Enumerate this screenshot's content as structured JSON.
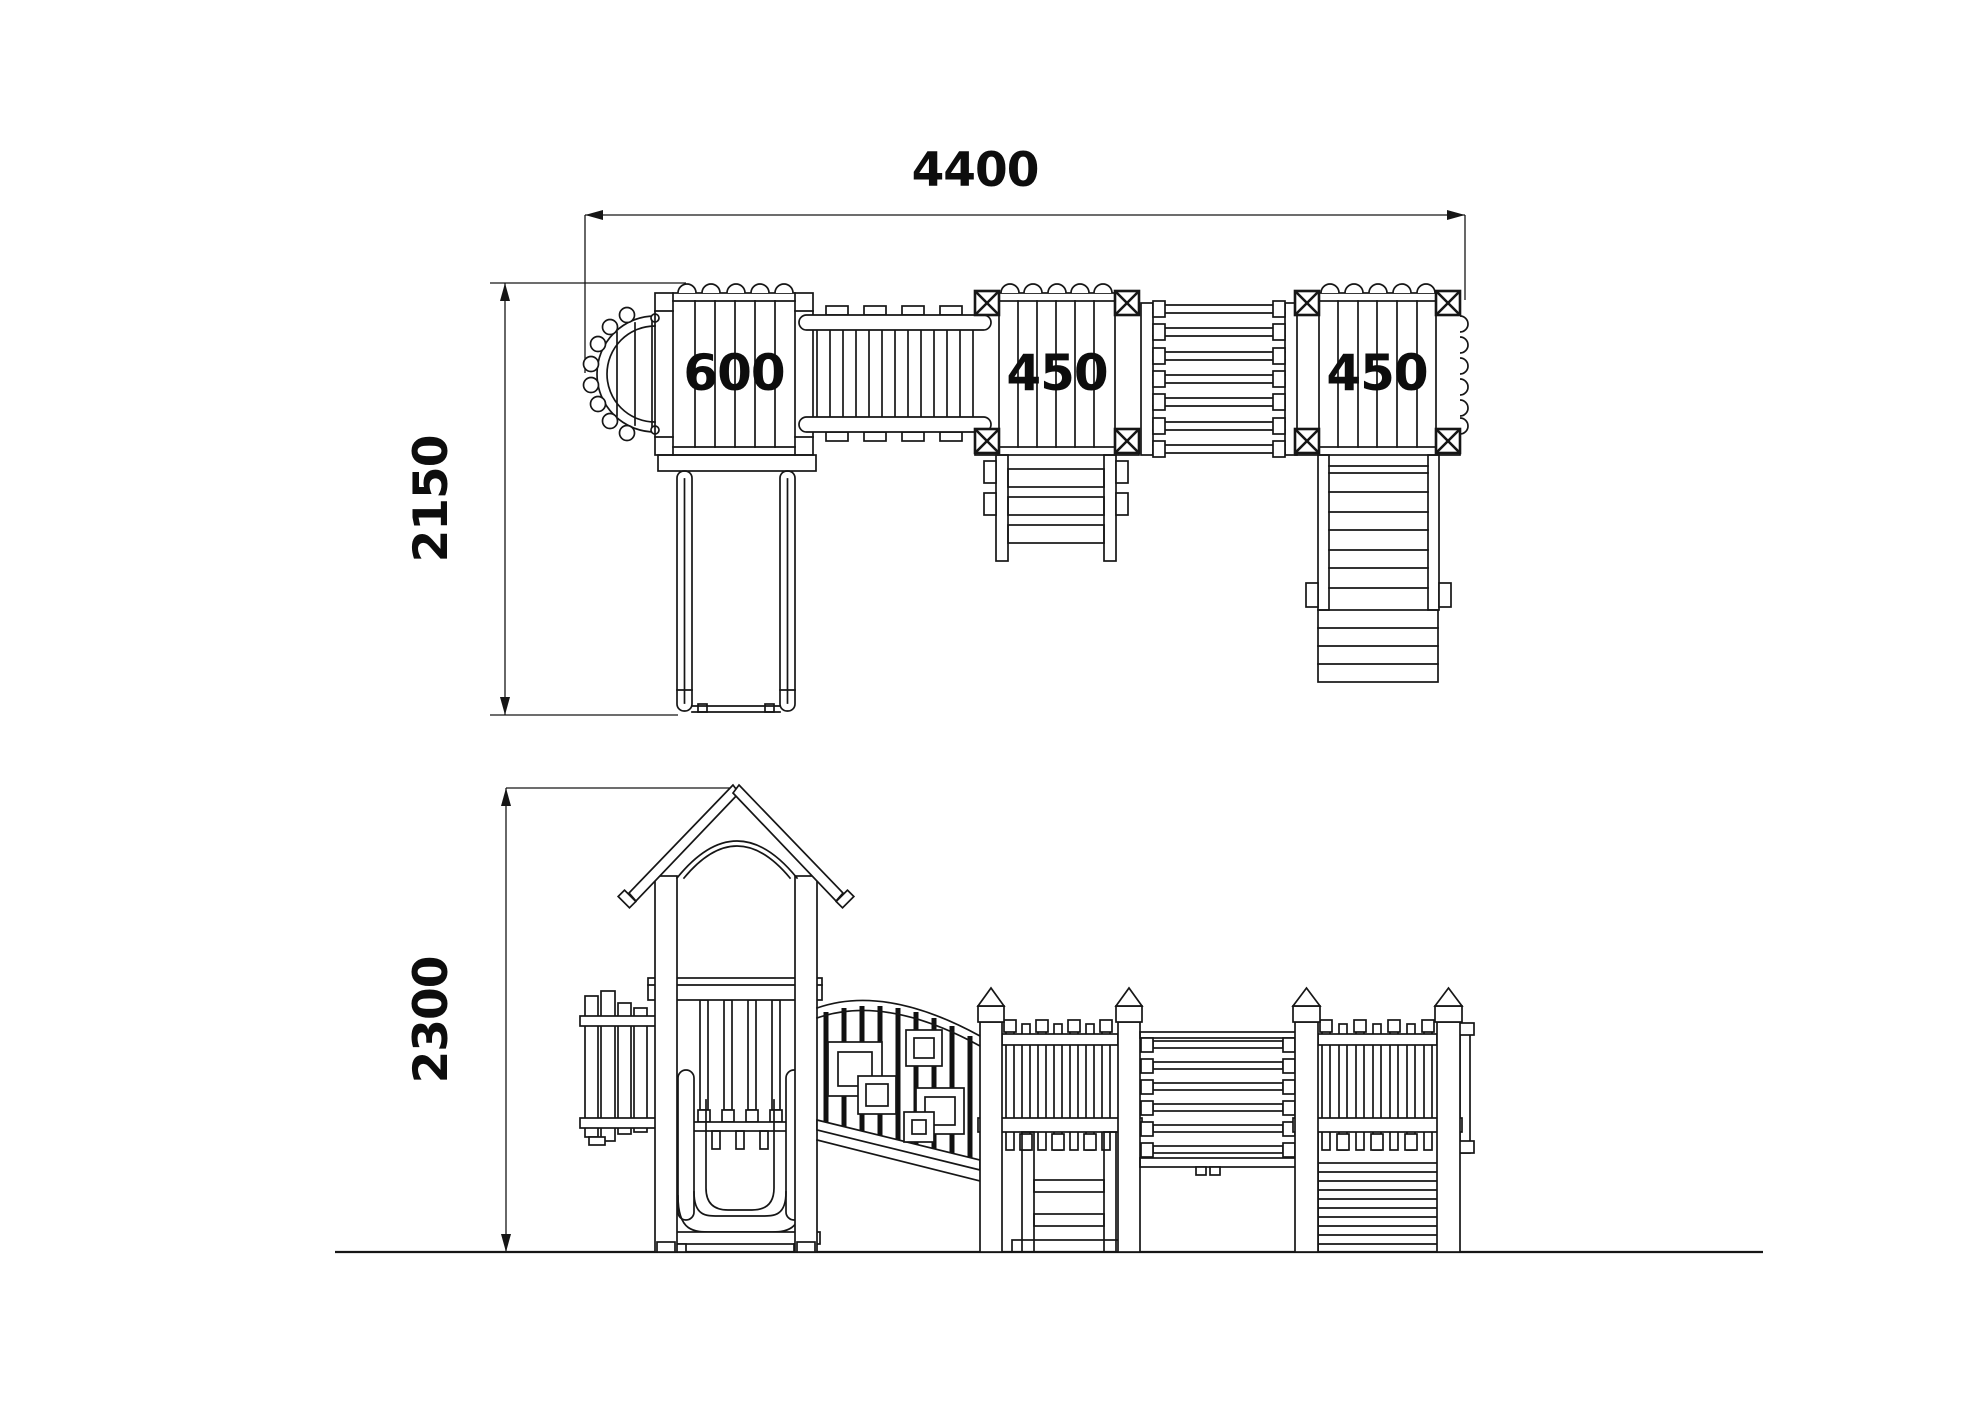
{
  "colors": {
    "background": "#ffffff",
    "line": "#161616"
  },
  "plan_view": {
    "overall_width": "4400",
    "overall_depth": "2150",
    "platforms": [
      {
        "label": "600"
      },
      {
        "label": "450"
      },
      {
        "label": "450"
      }
    ]
  },
  "elevation_view": {
    "overall_height": "2300"
  }
}
